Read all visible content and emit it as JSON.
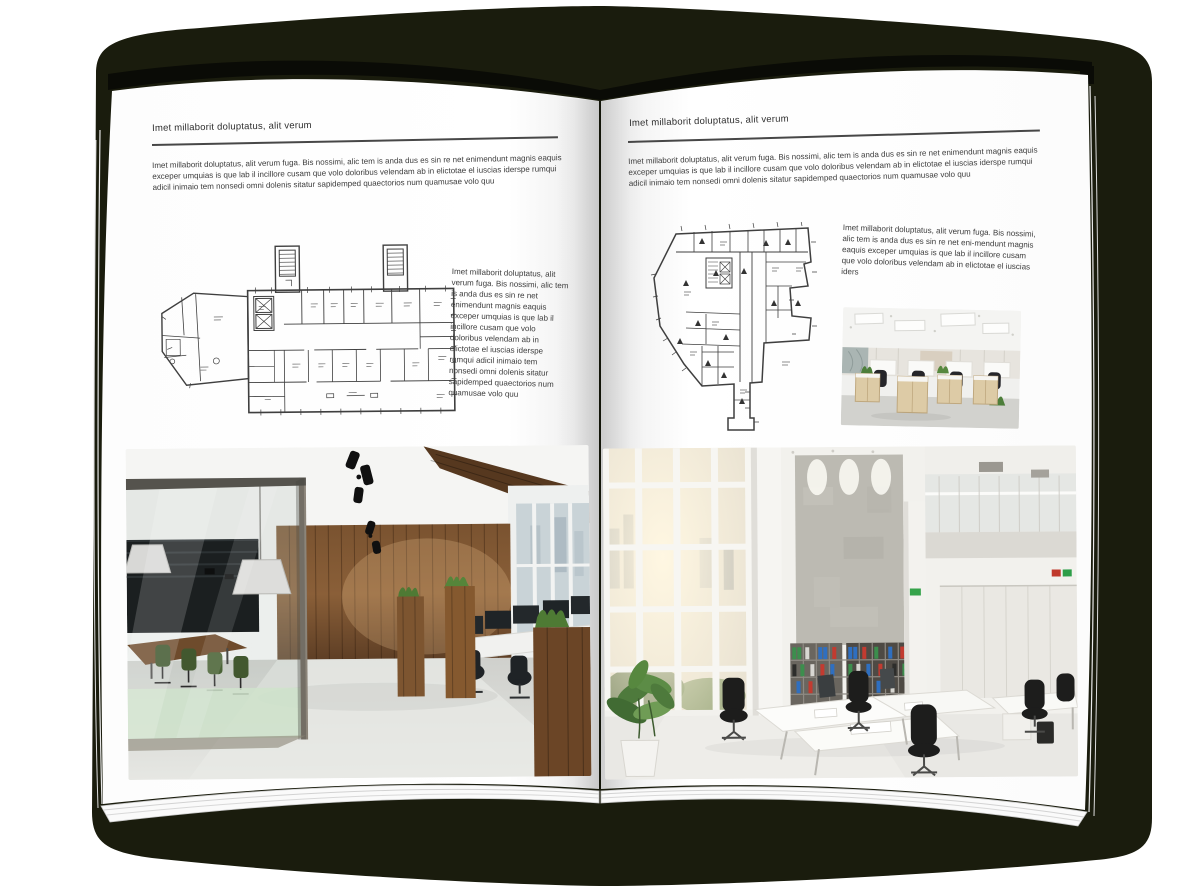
{
  "spread": {
    "page_left": {
      "header": "Imet millaborit doluptatus, alit verum",
      "intro": "Imet millaborit doluptatus, alit verum fuga. Bis nossimi, alic tem is anda dus es sin re net enimendunt magnis eaquis exceper umquias is que lab il incillore cusam que volo doloribus velendam ab in elictotae el iuscias iderspe rumqui adicil inimaio tem nonsedi omni dolenis sitatur sapidemped quaectorios num quamusae volo quu",
      "side_text": "Imet millaborit doluptatus, alit verum fuga. Bis nossimi, alic tem is anda dus es sin re net enimendunt magnis eaquis exceper umquias is que lab il incillore cusam que volo doloribus velendam ab in elictotae el iuscias iderspe rumqui adicil inimaio tem nonsedi omni dolenis sitatur sapidemped quaectorios num quamusae volo quu"
    },
    "page_right": {
      "header": "Imet millaborit doluptatus, alit verum",
      "intro": "Imet millaborit doluptatus, alit verum fuga. Bis nossimi, alic tem is anda dus es sin re net enimendunt magnis eaquis exceper umquias is que lab il incillore cusam que volo doloribus velendam ab in elictotae el iuscias iderspe rumqui adicil inimaio tem nonsedi omni dolenis sitatur sapidemped quaectorios num quamusae volo quu",
      "side_text": "Imet millaborit doluptatus, alit verum fuga. Bis nossimi, alic tem is anda dus es sin re net eni-mendunt magnis eaquis exceper umquias is que lab il incillore cusam que volo doloribus velendam ab in elictotae el iuscias iders"
    },
    "colors": {
      "backdrop": "#1a1c0d",
      "page": "#ffffff",
      "text": "#3c3c3c",
      "rule": "#474747",
      "plan_line": "#3f3f3f",
      "wood": "#6e4b2c",
      "meeting_glass_green": "#cfe3cb",
      "chair_green": "#42582f",
      "binder_green": "#3c8e4d",
      "binder_blue": "#2f6fc0",
      "binder_red": "#c23b30"
    }
  }
}
